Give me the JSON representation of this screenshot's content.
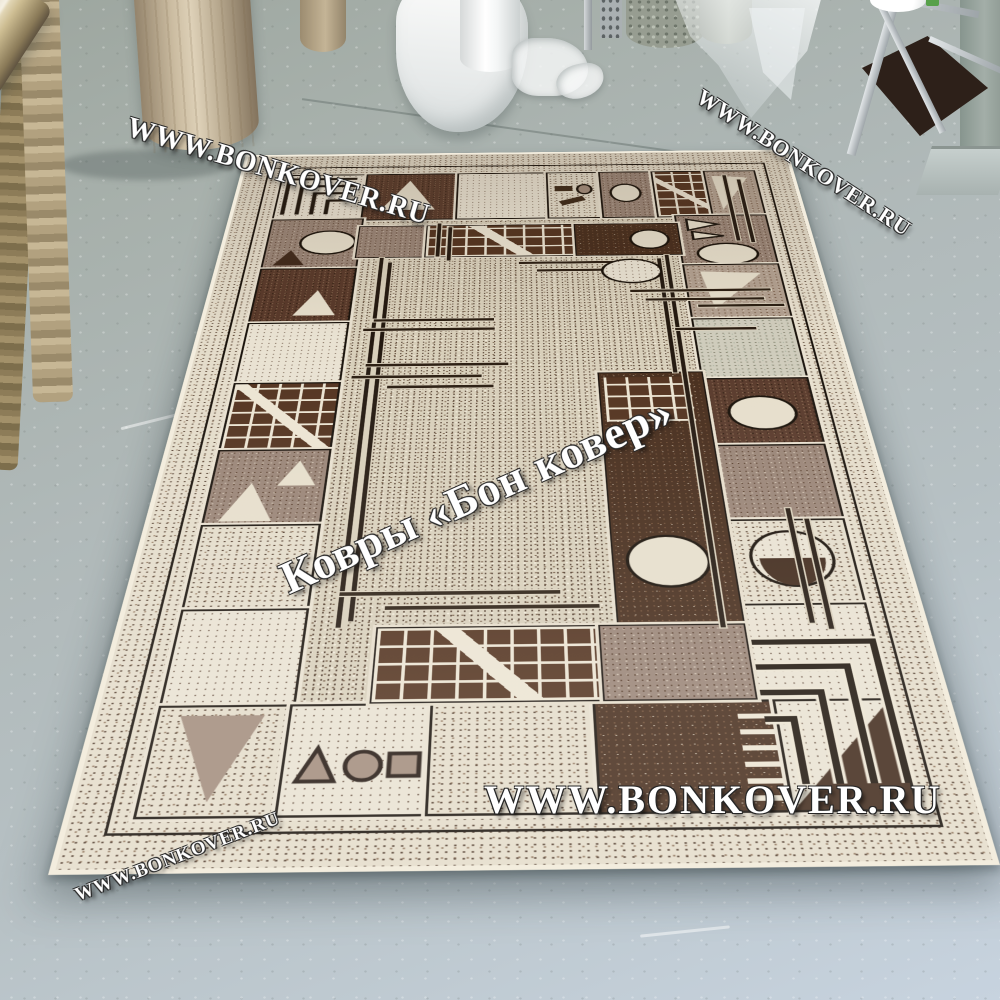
{
  "watermarks": {
    "top_left": "WWW.BONKOVER.RU",
    "top_right": "WWW.BONKOVER.RU",
    "center": "Ковры «Бон ковер»",
    "bottom_main": "WWW.BONKOVER.RU",
    "bottom_left": "WWW.BONKOVER.RU"
  },
  "scene": {
    "subject": "geometric-border-area-rug-displayed-on-floor",
    "objects": [
      "leaning-rolled-carpets",
      "standing-rolled-carpet",
      "white-plastic-film-roll",
      "crumpled-plastic-bags",
      "grey-carpet-rolls",
      "hanging-plastic-sheet",
      "metal-rack-trolley",
      "white-twine-spool",
      "concrete-column",
      "floor-ramp",
      "painted-concrete-floor"
    ],
    "rug_motifs": [
      "speckled-field",
      "tile-border-frame",
      "brick-grid-panels",
      "circle-and-pie-motifs",
      "triangle-motifs",
      "parallel-stick-bars",
      "greek-key-corner"
    ]
  },
  "palette": {
    "floor_top": "#9da69f",
    "floor_bottom": "#c7d3df",
    "rug_cream": "#e4dcca",
    "rug_field": "#d8cfba",
    "rug_mauve": "#998476",
    "rug_brown": "#58392a",
    "rug_chocolate": "#472d1c",
    "rug_outline_dark": "#1a130c",
    "rug_outline_light": "#e9e1d0",
    "watermark_color": "#ffffff"
  }
}
